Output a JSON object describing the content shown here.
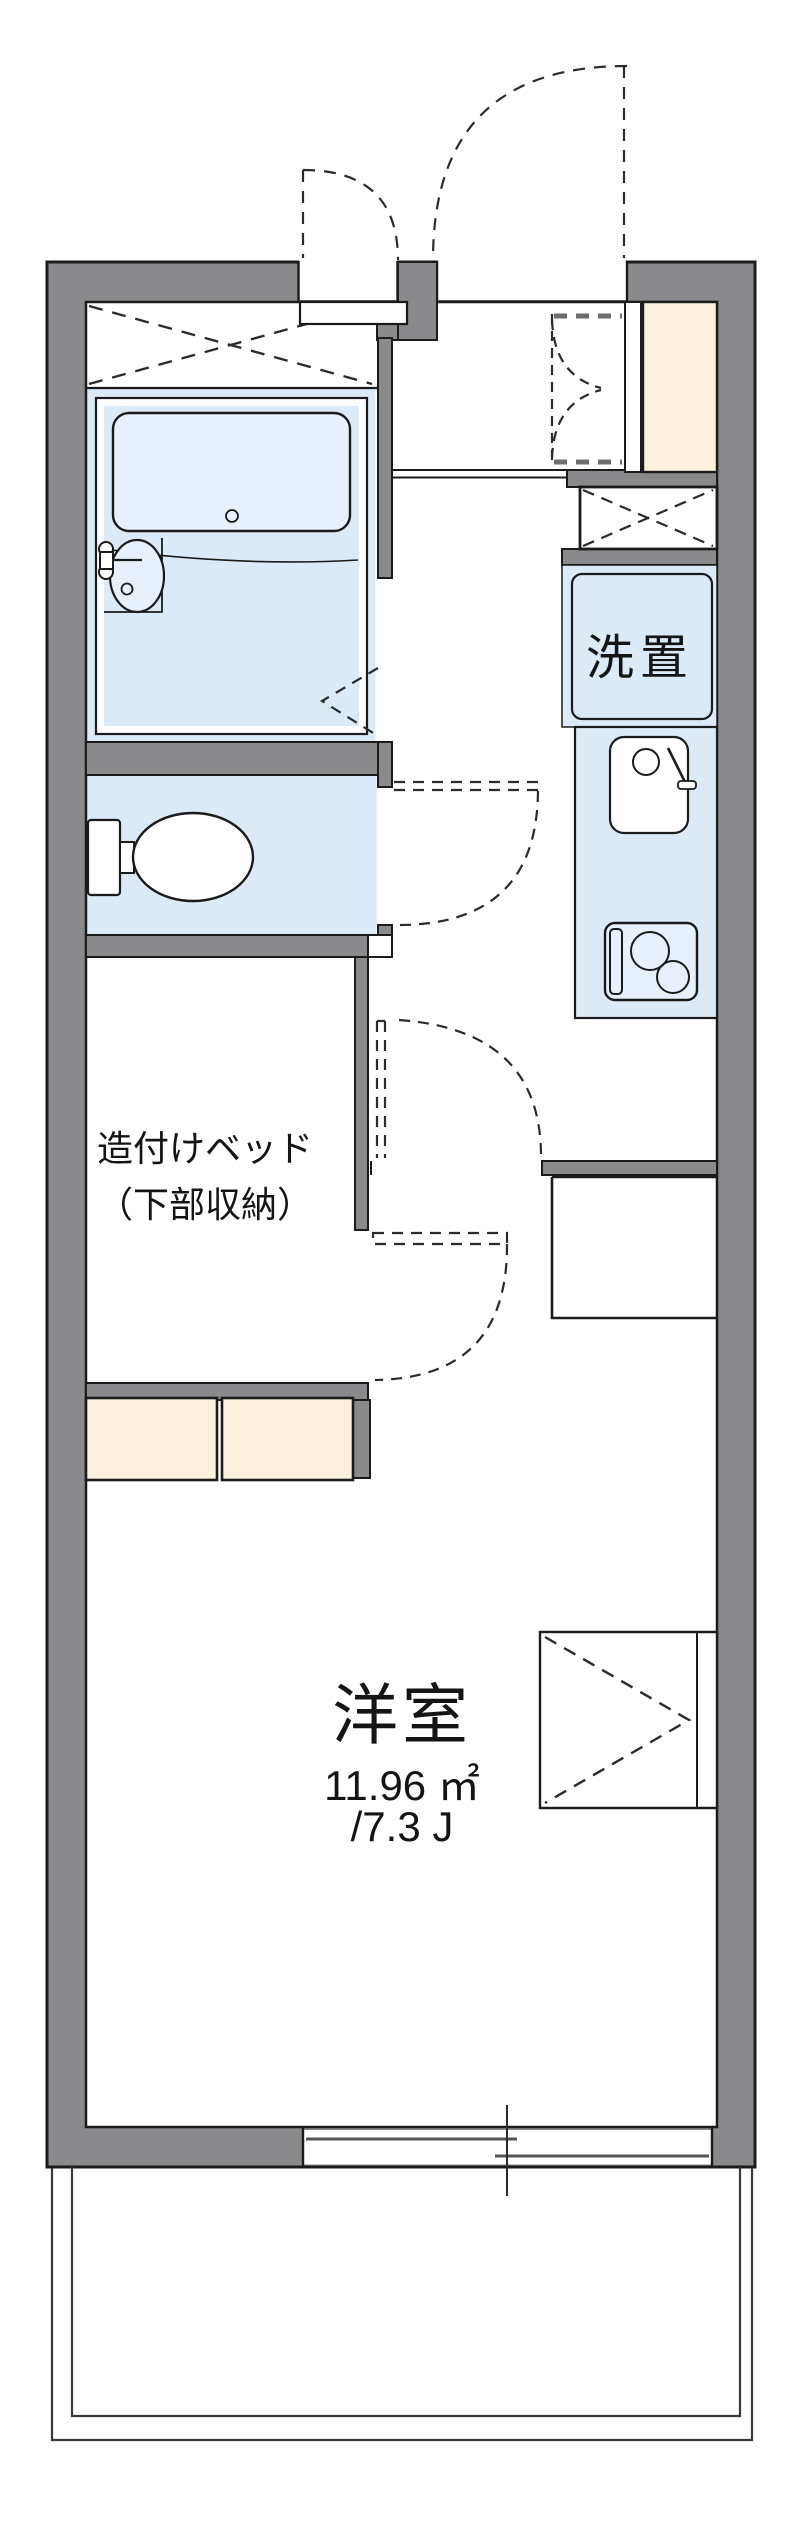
{
  "page": {
    "type": "apartment-floor-plan",
    "background": "#ffffff"
  },
  "labels": {
    "washer_space": "洗置",
    "built_in_bed_line1": "造付けベッド",
    "built_in_bed_line2": "（下部収納）",
    "western_room": "洋室",
    "western_room_area_m2": "11.96 ㎡",
    "western_room_area_tatami": "/7.3 J"
  },
  "colors": {
    "wall_fill": "#8a8a8c",
    "outline": "#1b1b1b",
    "wet_area_blue": "#dce9f7",
    "bathtub_blue": "#e7f0fb",
    "storage_cream": "#fbf1dc",
    "balcony_line": "#3a3a3a",
    "sash_gray": "#555555"
  },
  "fixtures": [
    "bathtub-icon",
    "washbasin-icon",
    "toilet-icon",
    "crossed-storage-icon",
    "shoe-cabinet",
    "folding-door-swing-icon",
    "entrance-door-swing-icon",
    "washer-space-panel",
    "kitchen-sink-icon",
    "gas-stove-icon",
    "door-swing-icon",
    "built-in-bed-room",
    "under-bed-storage-chests",
    "closet-chevron-icon",
    "sliding-window-icon",
    "balcony-rail"
  ]
}
